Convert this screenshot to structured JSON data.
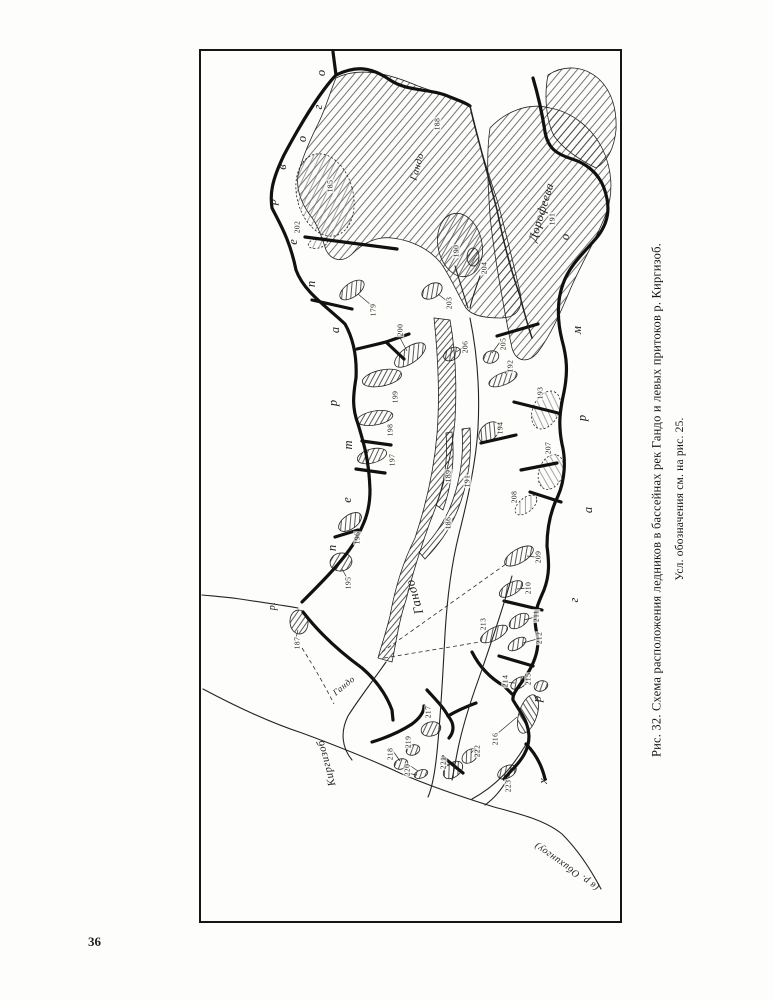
{
  "page": {
    "number": "36",
    "paper_color": "#fdfdfb",
    "ink_color": "#1d1d1d"
  },
  "figure": {
    "caption_line1": "Рис. 32. Схема расположения ледников  в бассейнах рек Гандо и левых  притоков р. Киргизоб.",
    "caption_line2": "Усл. обозначения см. на рис. 25."
  },
  "map": {
    "labels": [
      {
        "id": "glacier-gando-upper",
        "text": "Гандо",
        "x": 418,
        "y": 167,
        "rot": -74,
        "size": 10
      },
      {
        "id": "glacier-dorofeeva",
        "text": "Дорофеева",
        "x": 541,
        "y": 212,
        "rot": -73,
        "size": 12
      },
      {
        "id": "glacier-gando-tongue",
        "text": "Гандо",
        "x": 414,
        "y": 597,
        "rot": -106,
        "size": 13
      },
      {
        "id": "river-gando",
        "text": "Гандо",
        "x": 344,
        "y": 686,
        "rot": -39,
        "size": 9
      },
      {
        "id": "river-kirgizob",
        "text": "Киргизоб",
        "x": 327,
        "y": 763,
        "rot": -105,
        "size": 11
      },
      {
        "id": "river-obikhingou",
        "text": "(в р. Обихингоу)",
        "x": 567,
        "y": 866,
        "rot": -145,
        "size": 10
      },
      {
        "id": "river-left-exit",
        "text": "р.",
        "x": 273,
        "y": 606,
        "rot": -90,
        "size": 10
      }
    ],
    "ridge_letters_left": [
      {
        "ch": "о",
        "x": 321,
        "y": 73
      },
      {
        "ch": "г",
        "x": 318,
        "y": 107
      },
      {
        "ch": "о",
        "x": 302,
        "y": 139
      },
      {
        "ch": "в",
        "x": 282,
        "y": 167
      },
      {
        "ch": "р",
        "x": 272,
        "y": 202
      },
      {
        "ch": "е",
        "x": 293,
        "y": 242
      },
      {
        "ch": "п",
        "x": 311,
        "y": 284
      },
      {
        "ch": "а",
        "x": 335,
        "y": 330
      },
      {
        "ch": "р",
        "x": 333,
        "y": 403
      },
      {
        "ch": "т",
        "x": 348,
        "y": 445
      },
      {
        "ch": "е",
        "x": 347,
        "y": 500
      },
      {
        "ch": "п",
        "x": 332,
        "y": 548
      }
    ],
    "ridge_letters_right": [
      {
        "ch": "о",
        "x": 565,
        "y": 237
      },
      {
        "ch": "м",
        "x": 577,
        "y": 330
      },
      {
        "ch": "р",
        "x": 582,
        "y": 418
      },
      {
        "ch": "а",
        "x": 588,
        "y": 510
      },
      {
        "ch": "г",
        "x": 574,
        "y": 600
      },
      {
        "ch": "р",
        "x": 537,
        "y": 699
      },
      {
        "ch": "х",
        "x": 543,
        "y": 781
      }
    ],
    "glacier_numbers": [
      {
        "n": "179",
        "x": 373,
        "y": 310
      },
      {
        "n": "185",
        "x": 330,
        "y": 186
      },
      {
        "n": "186",
        "x": 448,
        "y": 523
      },
      {
        "n": "187",
        "x": 297,
        "y": 643
      },
      {
        "n": "188",
        "x": 437,
        "y": 124
      },
      {
        "n": "189",
        "x": 448,
        "y": 476
      },
      {
        "n": "190",
        "x": 456,
        "y": 251
      },
      {
        "n": "191",
        "x": 552,
        "y": 219
      },
      {
        "n": "191",
        "x": 467,
        "y": 481
      },
      {
        "n": "192",
        "x": 510,
        "y": 366
      },
      {
        "n": "193",
        "x": 540,
        "y": 393
      },
      {
        "n": "194",
        "x": 500,
        "y": 428
      },
      {
        "n": "195",
        "x": 348,
        "y": 583
      },
      {
        "n": "196",
        "x": 357,
        "y": 538
      },
      {
        "n": "197",
        "x": 392,
        "y": 460
      },
      {
        "n": "198",
        "x": 390,
        "y": 430
      },
      {
        "n": "199",
        "x": 395,
        "y": 397
      },
      {
        "n": "200",
        "x": 400,
        "y": 330
      },
      {
        "n": "202",
        "x": 297,
        "y": 227
      },
      {
        "n": "203",
        "x": 449,
        "y": 303
      },
      {
        "n": "204",
        "x": 484,
        "y": 268
      },
      {
        "n": "205",
        "x": 503,
        "y": 344
      },
      {
        "n": "206",
        "x": 465,
        "y": 347
      },
      {
        "n": "207",
        "x": 548,
        "y": 448
      },
      {
        "n": "208",
        "x": 514,
        "y": 497
      },
      {
        "n": "209",
        "x": 538,
        "y": 557
      },
      {
        "n": "210",
        "x": 528,
        "y": 588
      },
      {
        "n": "211",
        "x": 536,
        "y": 616
      },
      {
        "n": "212",
        "x": 539,
        "y": 638
      },
      {
        "n": "213",
        "x": 483,
        "y": 624
      },
      {
        "n": "214",
        "x": 505,
        "y": 681
      },
      {
        "n": "215",
        "x": 528,
        "y": 679
      },
      {
        "n": "216",
        "x": 495,
        "y": 739
      },
      {
        "n": "217",
        "x": 428,
        "y": 712
      },
      {
        "n": "218",
        "x": 390,
        "y": 754
      },
      {
        "n": "219",
        "x": 408,
        "y": 742
      },
      {
        "n": "220",
        "x": 407,
        "y": 770
      },
      {
        "n": "221",
        "x": 443,
        "y": 763
      },
      {
        "n": "222",
        "x": 477,
        "y": 751
      },
      {
        "n": "223",
        "x": 508,
        "y": 786
      }
    ]
  }
}
